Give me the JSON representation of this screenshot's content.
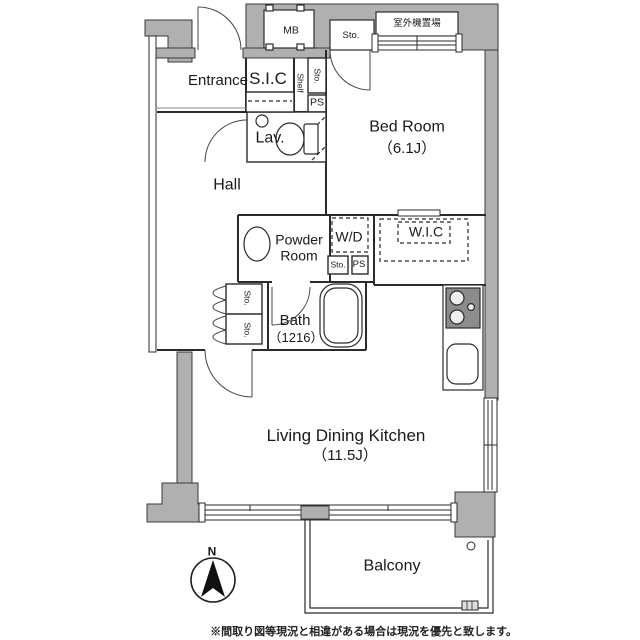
{
  "plan": {
    "colors": {
      "wall_gray": "#b0b0b0",
      "line": "#2b2b2b",
      "text": "#1a1a1a"
    },
    "labels": {
      "mb": "MB",
      "sto": "Sto.",
      "outdoor_unit": "室外機置場",
      "entrance": "Entrance",
      "sic": "S.I.C",
      "shelf": "Shelf",
      "ps": "PS",
      "lav": "Lav.",
      "bedroom_name": "Bed Room",
      "bedroom_size": "（6.1J）",
      "hall": "Hall",
      "powder_room_line1": "Powder",
      "powder_room_line2": "Room",
      "wd": "W/D",
      "wic": "W.I.C",
      "bath_name": "Bath",
      "bath_size": "（1216）",
      "ldk_name": "Living Dining Kitchen",
      "ldk_size": "（11.5J）",
      "balcony": "Balcony",
      "compass_north": "N"
    },
    "footnote": "※間取り図等現況と相違がある場合は現況を優先と致します。"
  }
}
